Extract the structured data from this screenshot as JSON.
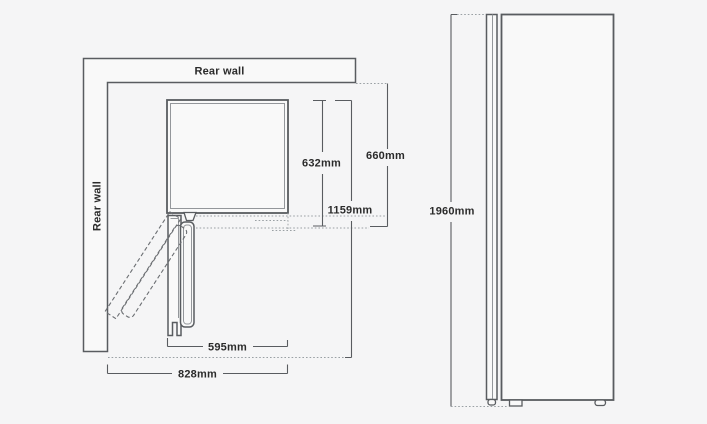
{
  "colors": {
    "background": "#f5f5f6",
    "line": "#595c60",
    "line_light": "#9aa0a4",
    "text": "#2b2b2b",
    "shape_fill": "#f9f9f9"
  },
  "top_view": {
    "rear_wall_top": "Rear wall",
    "rear_wall_side": "Rear wall",
    "dims": {
      "cabinet_depth": "632mm",
      "total_depth": "660mm",
      "depth_door_open": "1159mm",
      "cabinet_width": "595mm",
      "total_width_clearance": "828mm"
    }
  },
  "side_view": {
    "dims": {
      "height": "1960mm"
    }
  }
}
